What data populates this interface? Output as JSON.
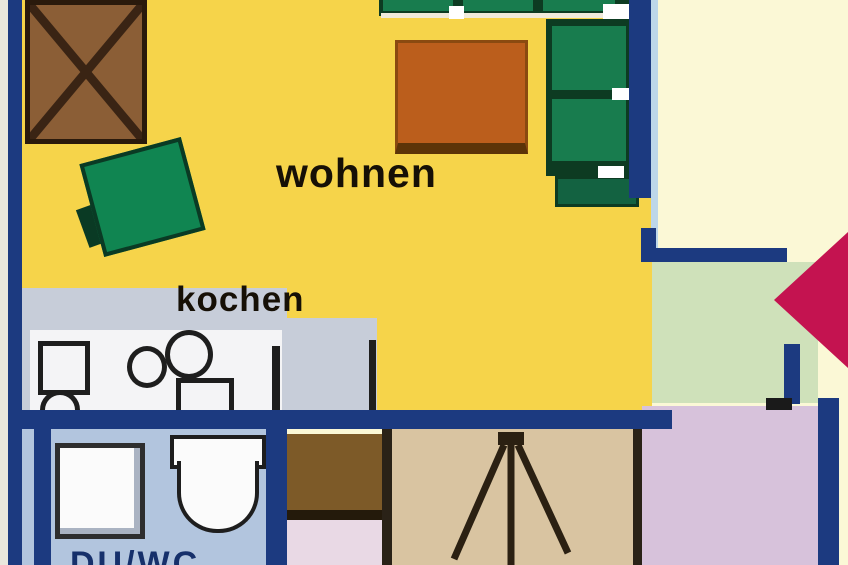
{
  "labels": {
    "living_room": "wohnen",
    "kitchen": "kochen",
    "bathroom": "DU/WC"
  },
  "icons": {
    "entrance_arrow": "left-pointing entrance arrow",
    "door_swing": "door swing symbol",
    "table_cross": "table marked with X"
  },
  "colors": {
    "exterior": "#fbf8d6",
    "exterior-edge": "#e9e7dd",
    "wall": "#1c3a80",
    "wall-edge": "#bdd7e9",
    "living": "#f6d44a",
    "kitchen": "#c7cdd9",
    "counter": "#f4f4f6",
    "fixture": "#1e1e1e",
    "sofa": "#187c4e",
    "sofa-dark": "#0d3b22",
    "sofa-end": "#136241",
    "chair": "#108551",
    "chair-dark": "#0a3a24",
    "wood": "#8b5e36",
    "wood-border": "#2a1a0c",
    "wood-x": "#3a2414",
    "coffee": "#bb5e1c",
    "coffee-border": "#8a4a10",
    "coffee-edge": "#5c3408",
    "bath": "#b2c5de",
    "sanitary": "#fbfbfb",
    "sanitary-line": "#efeadb",
    "entry": "#cfe1ba",
    "arrow": "#c41350",
    "lavender": "#d7c2db",
    "tan": "#d9c4a1",
    "brown": "#7d5a28",
    "brown-edge": "#241a0b",
    "pink": "#e9d9e5",
    "divider-dark": "#2a2217",
    "door": "#2b2012",
    "text": "#161006",
    "bath-text": "#16306b",
    "stub": "#1a1a1a"
  }
}
